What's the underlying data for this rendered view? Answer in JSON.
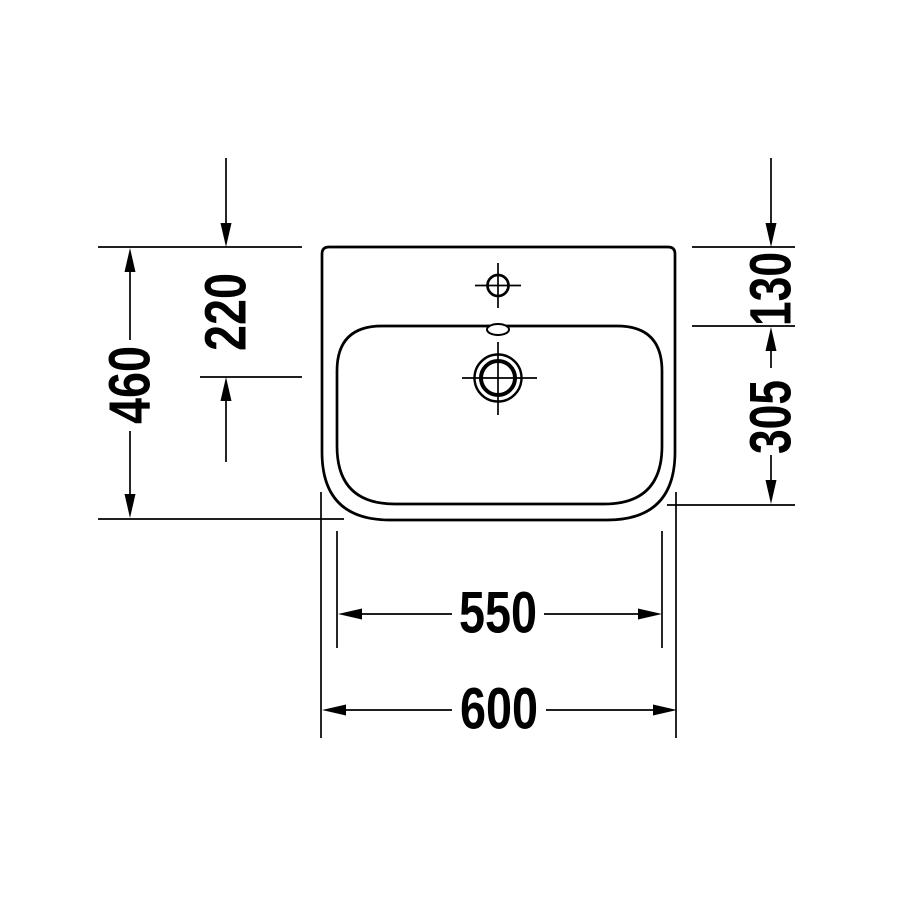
{
  "drawing": {
    "background": "#ffffff",
    "line_color": "#000000",
    "dimensions": {
      "depth_overall": "460",
      "depth_to_drain_center": "220",
      "back_edge_to_basin": "130",
      "basin_depth": "305",
      "basin_width": "550",
      "width_overall": "600"
    }
  }
}
